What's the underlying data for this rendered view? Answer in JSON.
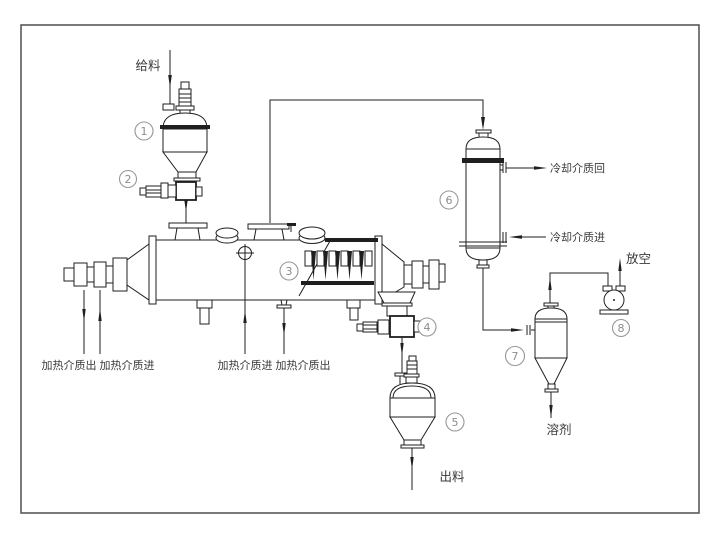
{
  "colors": {
    "background": "#ffffff",
    "line": "#1f1f1f",
    "frame": "#4f4f4f",
    "tag": "#8c8c8c",
    "label_text": "#3a3a3a"
  },
  "labels": {
    "feed": "给料",
    "discharge": "出料",
    "solvent": "溶剂",
    "vent": "放空",
    "cooling_return": "冷却介质回",
    "cooling_in": "冷却介质进",
    "heating_out_left": "加热介质出",
    "heating_in_left": "加热介质进",
    "heating_in_mid": "加热介质进",
    "heating_out_mid": "加热介质出"
  },
  "tags": {
    "t1": "1",
    "t2": "2",
    "t3": "3",
    "t4": "4",
    "t5": "5",
    "t6": "6",
    "t7": "7",
    "t8": "8"
  }
}
